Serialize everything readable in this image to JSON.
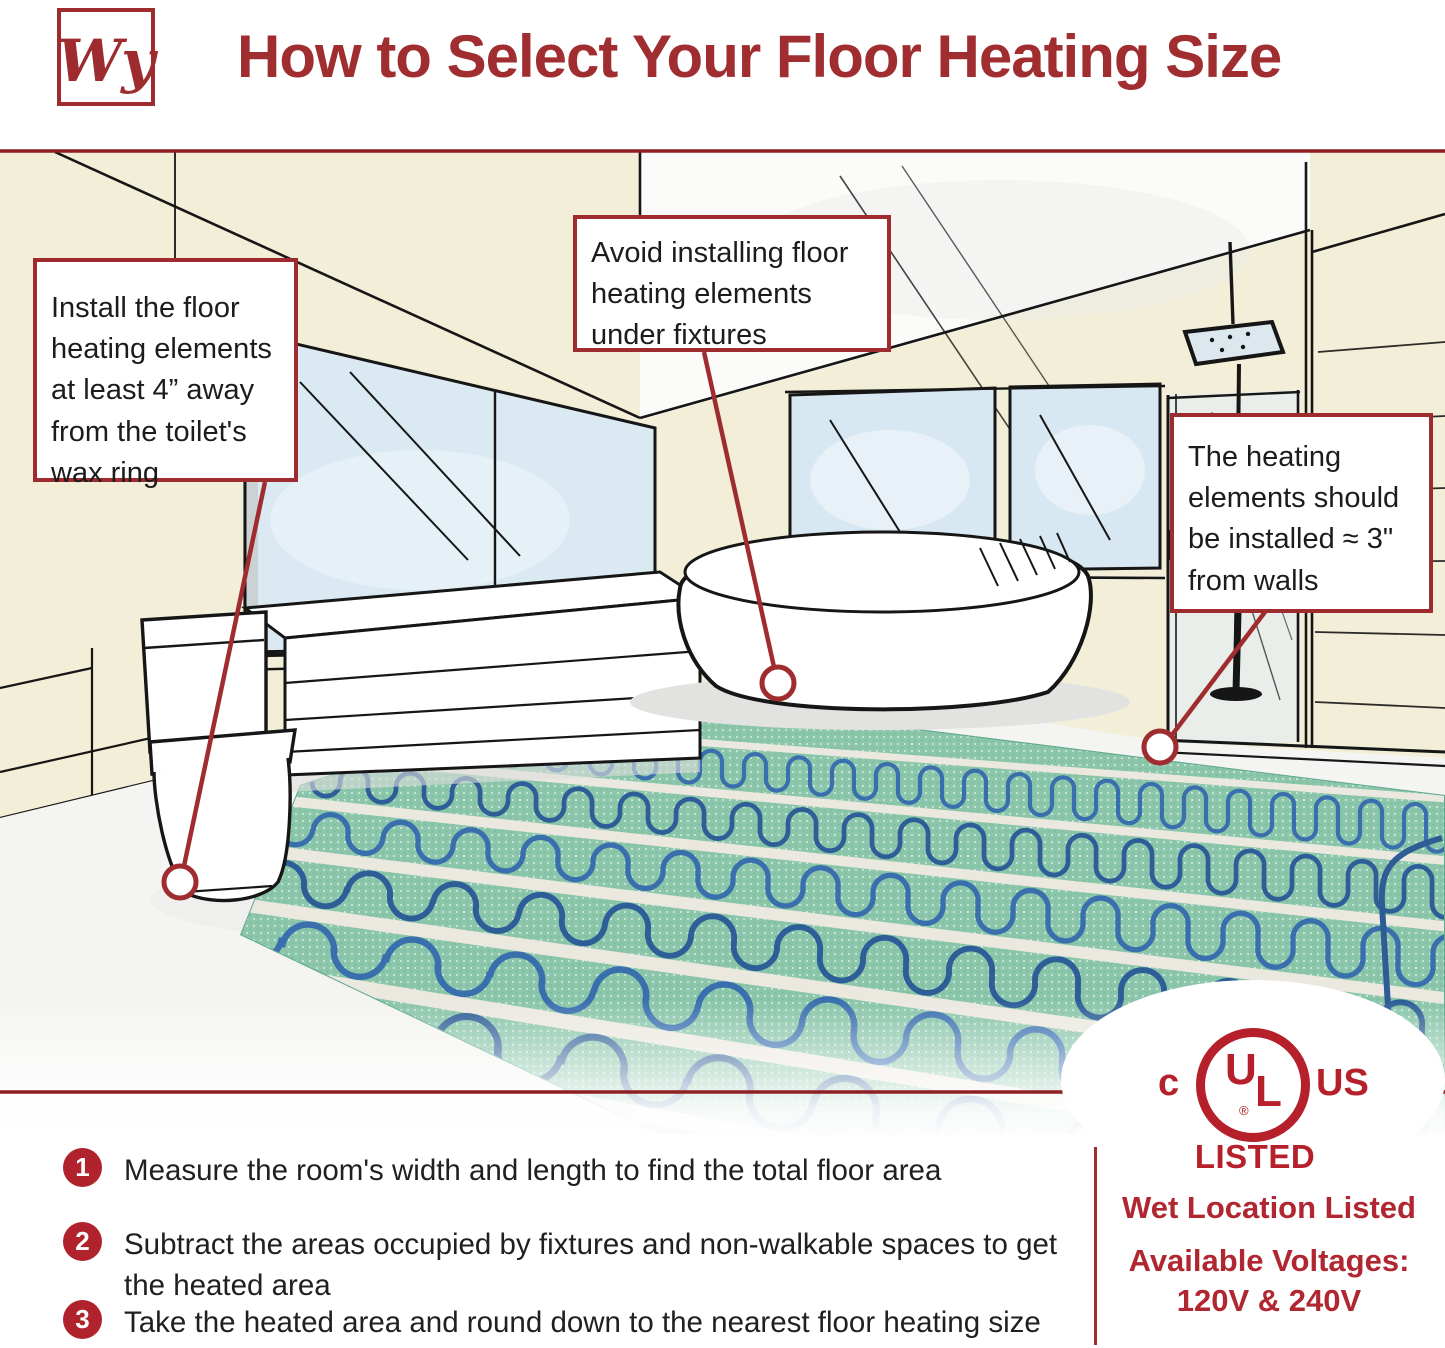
{
  "header": {
    "logo_monogram": "Wy",
    "title": "How to Select Your Floor Heating Size"
  },
  "callouts": {
    "toilet": "Install the floor heating elements at least 4” away from the toilet's wax ring",
    "fixtures": "Avoid installing floor heating elements under fixtures",
    "walls": "The heating elements should be installed ≈ 3\" from walls"
  },
  "steps": [
    {
      "number": "1",
      "text": "Measure the room's width and length to find the total floor area"
    },
    {
      "number": "2",
      "text": "Subtract the areas occupied by fixtures and non-walkable spaces to get the heated area"
    },
    {
      "number": "3",
      "text": "Take the heated area and round down to the nearest floor heating size"
    }
  ],
  "certification": {
    "c": "c",
    "u": "U",
    "l": "L",
    "us": "US",
    "registered": "®",
    "listed": "LISTED",
    "wet_location": "Wet Location Listed",
    "voltages_label": "Available Voltages:",
    "voltages_value": "120V & 240V"
  },
  "colors": {
    "brand_red": "#9f2c2e",
    "ul_red": "#b5202a",
    "wall_cream": "#f3eed7",
    "window_blue": "#d9e8f2",
    "mat_green": "#84c3a6",
    "cable_blue": "#3a6fae"
  }
}
